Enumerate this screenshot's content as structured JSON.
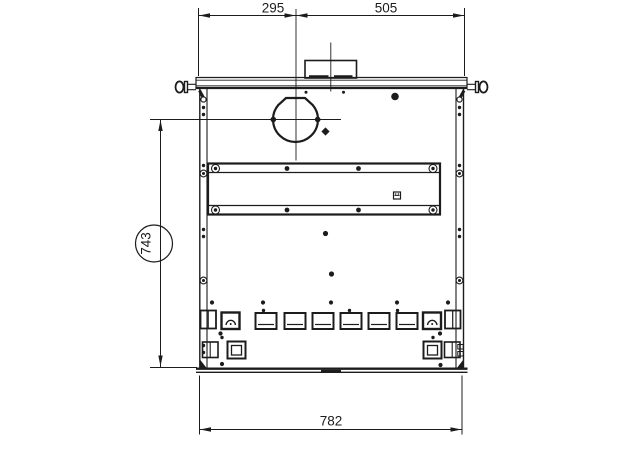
{
  "drawing": {
    "background_color": "#ffffff",
    "line_color": "#1c1c1c",
    "dimensions": {
      "top_left_width": "295",
      "top_right_width": "505",
      "side_height": "743",
      "bottom_width": "782"
    }
  }
}
